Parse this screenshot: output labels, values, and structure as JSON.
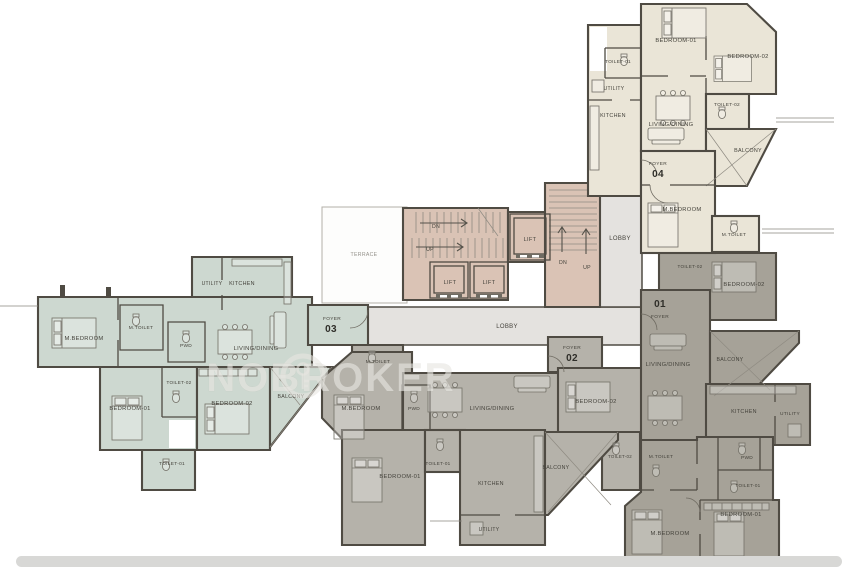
{
  "watermark": {
    "brand": "NOBROKER"
  },
  "colors": {
    "unit01": "#a6a298",
    "unit02": "#b5b2aa",
    "unit03": "#cdd8d0",
    "unit04": "#eae5d7",
    "core": "#dac3b5",
    "lobby": "#e4e2df",
    "terrace": "#fdfdfc",
    "wall": "#4f4b43"
  },
  "plan": {
    "common": {
      "labels": [
        {
          "t": "LOBBY",
          "x": 507,
          "y": 328,
          "s": 6
        },
        {
          "t": "LOBBY",
          "x": 620,
          "y": 240,
          "s": 6
        },
        {
          "t": "TERRACE",
          "x": 364,
          "y": 256,
          "s": 5.2,
          "m": true
        }
      ]
    },
    "core": {
      "labels": [
        {
          "t": "DN",
          "x": 436,
          "y": 228,
          "s": 5.2
        },
        {
          "t": "UP",
          "x": 430,
          "y": 251,
          "s": 5.2
        },
        {
          "t": "LIFT",
          "x": 450,
          "y": 284,
          "s": 5.6
        },
        {
          "t": "LIFT",
          "x": 489,
          "y": 284,
          "s": 5.6
        },
        {
          "t": "LIFT",
          "x": 530,
          "y": 241,
          "s": 5.6
        },
        {
          "t": "DN",
          "x": 563,
          "y": 264,
          "s": 5.2
        },
        {
          "t": "UP",
          "x": 587,
          "y": 269,
          "s": 5.2
        }
      ]
    },
    "units": [
      {
        "id": "04",
        "labels": [
          {
            "t": "TOILET-01",
            "x": 618,
            "y": 63,
            "s": 4.8
          },
          {
            "t": "BEDROOM-01",
            "x": 676,
            "y": 42
          },
          {
            "t": "BEDROOM-02",
            "x": 748,
            "y": 58
          },
          {
            "t": "UTILITY",
            "x": 614,
            "y": 90,
            "s": 5
          },
          {
            "t": "KITCHEN",
            "x": 613,
            "y": 117,
            "s": 5.4
          },
          {
            "t": "LIVING/DINING",
            "x": 671,
            "y": 126
          },
          {
            "t": "TOILET-02",
            "x": 727,
            "y": 106,
            "s": 4.8
          },
          {
            "t": "BALCONY",
            "x": 748,
            "y": 152,
            "s": 5.4
          },
          {
            "t": "FOYER",
            "x": 658,
            "y": 165,
            "s": 4.8
          },
          {
            "t": "04",
            "x": 658,
            "y": 177,
            "s": 10,
            "b": true
          },
          {
            "t": "M.BEDROOM",
            "x": 682,
            "y": 211
          },
          {
            "t": "M.TOILET",
            "x": 734,
            "y": 236,
            "s": 4.8
          }
        ]
      },
      {
        "id": "03",
        "labels": [
          {
            "t": "UTILITY",
            "x": 212,
            "y": 285,
            "s": 5
          },
          {
            "t": "KITCHEN",
            "x": 242,
            "y": 285,
            "s": 5.4
          },
          {
            "t": "M.BEDROOM",
            "x": 84,
            "y": 340
          },
          {
            "t": "M.TOILET",
            "x": 141,
            "y": 329,
            "s": 4.8
          },
          {
            "t": "PWD",
            "x": 186,
            "y": 347,
            "s": 4.8
          },
          {
            "t": "LIVING/DINING",
            "x": 256,
            "y": 350
          },
          {
            "t": "FOYER",
            "x": 332,
            "y": 320,
            "s": 4.8
          },
          {
            "t": "03",
            "x": 331,
            "y": 332,
            "s": 10,
            "b": true
          },
          {
            "t": "TOILET-02",
            "x": 179,
            "y": 384,
            "s": 4.6
          },
          {
            "t": "BEDROOM-01",
            "x": 130,
            "y": 410
          },
          {
            "t": "BEDROOM-02",
            "x": 232,
            "y": 405
          },
          {
            "t": "BALCONY",
            "x": 291,
            "y": 398,
            "s": 5.2
          },
          {
            "t": "TOILET-01",
            "x": 172,
            "y": 465,
            "s": 4.8
          }
        ]
      },
      {
        "id": "02",
        "labels": [
          {
            "t": "M.TOILET",
            "x": 378,
            "y": 363,
            "s": 4.8
          },
          {
            "t": "M.BEDROOM",
            "x": 361,
            "y": 410
          },
          {
            "t": "PWD",
            "x": 414,
            "y": 410,
            "s": 4.8
          },
          {
            "t": "LIVING/DINING",
            "x": 492,
            "y": 410
          },
          {
            "t": "FOYER",
            "x": 572,
            "y": 349,
            "s": 4.8
          },
          {
            "t": "02",
            "x": 572,
            "y": 361,
            "s": 10,
            "b": true
          },
          {
            "t": "BEDROOM-02",
            "x": 596,
            "y": 403
          },
          {
            "t": "TOILET-02",
            "x": 620,
            "y": 458,
            "s": 4.4
          },
          {
            "t": "TOILET-01",
            "x": 438,
            "y": 465,
            "s": 4.6
          },
          {
            "t": "BEDROOM-01",
            "x": 400,
            "y": 478
          },
          {
            "t": "KITCHEN",
            "x": 491,
            "y": 485,
            "s": 5.4
          },
          {
            "t": "UTILITY",
            "x": 489,
            "y": 531,
            "s": 5
          },
          {
            "t": "BALCONY",
            "x": 556,
            "y": 469,
            "s": 5.2
          }
        ]
      },
      {
        "id": "01",
        "labels": [
          {
            "t": "TOILET-02",
            "x": 690,
            "y": 268,
            "s": 4.6
          },
          {
            "t": "BEDROOM-02",
            "x": 744,
            "y": 286
          },
          {
            "t": "01",
            "x": 660,
            "y": 307,
            "s": 10,
            "b": true
          },
          {
            "t": "FOYER",
            "x": 660,
            "y": 318,
            "s": 4.8
          },
          {
            "t": "LIVING/DINING",
            "x": 668,
            "y": 366
          },
          {
            "t": "BALCONY",
            "x": 730,
            "y": 361,
            "s": 5.2
          },
          {
            "t": "KITCHEN",
            "x": 744,
            "y": 413,
            "s": 5.4
          },
          {
            "t": "UTILITY",
            "x": 790,
            "y": 415,
            "s": 4.8
          },
          {
            "t": "M.TOILET",
            "x": 661,
            "y": 458,
            "s": 4.8
          },
          {
            "t": "PWD",
            "x": 747,
            "y": 459,
            "s": 4.8
          },
          {
            "t": "TOILET-01",
            "x": 748,
            "y": 487,
            "s": 4.6
          },
          {
            "t": "BEDROOM-01",
            "x": 741,
            "y": 516
          },
          {
            "t": "M.BEDROOM",
            "x": 670,
            "y": 535
          }
        ]
      }
    ]
  }
}
